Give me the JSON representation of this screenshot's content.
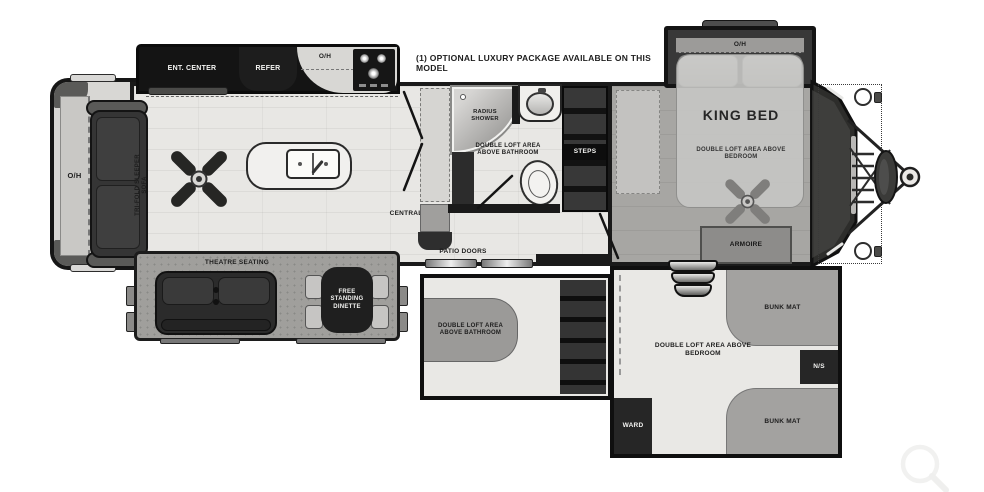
{
  "note": "(1) OPTIONAL LUXURY PACKAGE AVAILABLE ON THIS MODEL",
  "labels": {
    "oh": "O/H",
    "ent_center": "ENT. CENTER",
    "refer": "REFER",
    "tri_fold_sofa": "TRI-FOLD SLEEPER SOFA",
    "central_vac": "CENTRAL VAC",
    "radius_shower": "RADIUS SHOWER",
    "double_loft_bathroom": "DOUBLE LOFT AREA ABOVE BATHROOM",
    "steps": "STEPS",
    "patio_doors": "PATIO DOORS",
    "theatre_seating": "THEATRE SEATING",
    "free_standing_dinette": "FREE STANDING DINETTE",
    "king_bed": "KING BED",
    "double_loft_bedroom": "DOUBLE LOFT AREA ABOVE BEDROOM",
    "armoire": "ARMOIRE",
    "bunk_mat": "BUNK MAT",
    "ns": "N/S",
    "ward": "WARD"
  },
  "icons": {
    "ceiling_fan": "four-blade ceiling fan",
    "kitchen_sink": "double-basin kitchen sink with faucet",
    "stove": "range with burners and oven",
    "bathroom_sink": "oval lavatory sink",
    "toilet": "toilet",
    "shower": "radius corner shower",
    "hitch": "trailer a-frame hitch with propane tank and coupler",
    "entry_steps": "curved entry steps",
    "magnifier": "zoom magnifier watermark"
  },
  "colors": {
    "wall": "#161616",
    "floor_light": "#e8e7e4",
    "floor_bedroom": "#a7a6a3",
    "slide_gray": "#a09f9c",
    "mat_gray": "#a3a2a0",
    "dark_furniture": "#2c2c2c",
    "background": "#ffffff"
  }
}
